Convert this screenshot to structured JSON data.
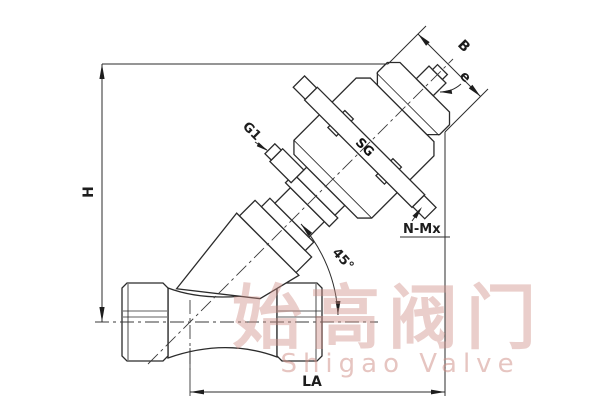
{
  "labels": {
    "h": "H",
    "b": "B",
    "e": "e",
    "g_port": "G1",
    "n_mx": "N-Mx",
    "angle": "45°",
    "la": "LA"
  },
  "actuator_logo": "SG",
  "watermark": {
    "cn": "始高阀门",
    "en": "Shigao Valve"
  },
  "colors": {
    "line": "#2b2b2b",
    "watermark": "#cf8d84",
    "background": "#ffffff"
  }
}
